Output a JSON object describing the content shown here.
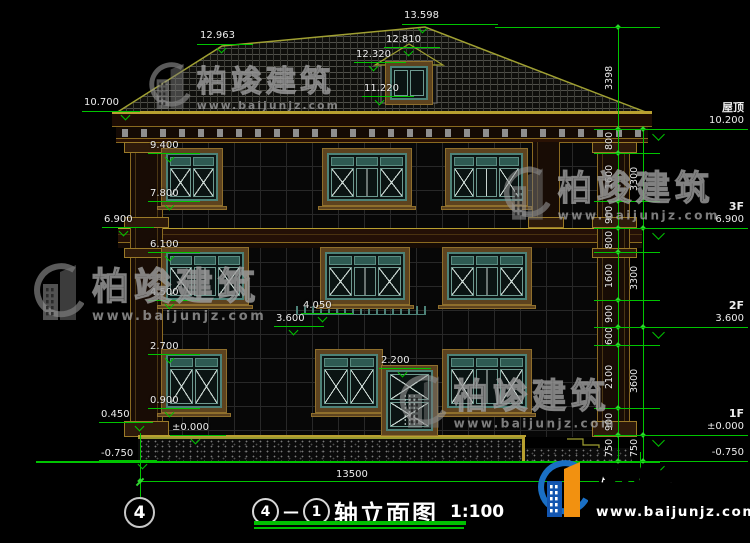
{
  "watermark": {
    "brand": "柏竣建筑",
    "url": "www.baijunjz.com"
  },
  "title_block": {
    "axis_start": "4",
    "separator": "—",
    "axis_end": "1",
    "title": "轴立面图",
    "scale": "1:100"
  },
  "axis_bubble": "4",
  "colors": {
    "dim_green": "#00c400",
    "trim_yellow": "#a0a032",
    "frame_teal": "#4d8278",
    "logo_blue": "#1a6fc4",
    "logo_orange": "#f29110",
    "text_white": "#e8e8e8"
  },
  "drawing": {
    "levels_left": [
      {
        "label": "13.598",
        "tx": 404,
        "ty": 10,
        "lx": 402,
        "ly": 24,
        "lw": 96,
        "vx": 423
      },
      {
        "label": "12.963",
        "tx": 200,
        "ty": 30,
        "lx": 197,
        "ly": 44,
        "lw": 56,
        "vx": 222
      },
      {
        "label": "12.810",
        "tx": 386,
        "ty": 34,
        "lx": 384,
        "ly": 47,
        "lw": 56,
        "vx": 409
      },
      {
        "label": "12.320",
        "tx": 356,
        "ty": 49,
        "lx": 354,
        "ly": 62,
        "lw": 52,
        "vx": 374
      },
      {
        "label": "11.220",
        "tx": 364,
        "ty": 83,
        "lx": 362,
        "ly": 96,
        "lw": 52,
        "vx": 380
      },
      {
        "label": "10.700",
        "tx": 84,
        "ty": 97,
        "lx": 82,
        "ly": 111,
        "lw": 58,
        "vx": 126
      },
      {
        "label": "9.400",
        "tx": 150,
        "ty": 140,
        "lx": 148,
        "ly": 153,
        "lw": 52,
        "vx": 170
      },
      {
        "label": "7.800",
        "tx": 150,
        "ty": 188,
        "lx": 148,
        "ly": 201,
        "lw": 52,
        "vx": 170
      },
      {
        "label": "6.900",
        "tx": 104,
        "ty": 214,
        "lx": 102,
        "ly": 227,
        "lw": 52,
        "vx": 124
      },
      {
        "label": "6.100",
        "tx": 150,
        "ty": 239,
        "lx": 148,
        "ly": 252,
        "lw": 52,
        "vx": 170
      },
      {
        "label": "4.500",
        "tx": 150,
        "ty": 287,
        "lx": 148,
        "ly": 300,
        "lw": 52,
        "vx": 170
      },
      {
        "label": "4.050",
        "tx": 303,
        "ty": 300,
        "lx": 301,
        "ly": 313,
        "lw": 52,
        "vx": 323
      },
      {
        "label": "3.600",
        "tx": 276,
        "ty": 313,
        "lx": 274,
        "ly": 326,
        "lw": 50,
        "vx": 294
      },
      {
        "label": "2.700",
        "tx": 150,
        "ty": 341,
        "lx": 148,
        "ly": 354,
        "lw": 52,
        "vx": 170
      },
      {
        "label": "2.200",
        "tx": 381,
        "ty": 355,
        "lx": 379,
        "ly": 368,
        "lw": 52,
        "vx": 403
      },
      {
        "label": "0.900",
        "tx": 150,
        "ty": 395,
        "lx": 148,
        "ly": 408,
        "lw": 52,
        "vx": 170
      },
      {
        "label": "0.450",
        "tx": 101,
        "ty": 409,
        "lx": 99,
        "ly": 422,
        "lw": 54,
        "vx": 140
      },
      {
        "label": "±0.000",
        "tx": 172,
        "ty": 422,
        "lx": 170,
        "ly": 435,
        "lw": 56,
        "vx": 196
      },
      {
        "label": "-0.750",
        "tx": 101,
        "ty": 448,
        "lx": 99,
        "ly": 460,
        "lw": 58,
        "vx": 143
      }
    ],
    "levels_right": [
      {
        "name": "屋顶",
        "value": "10.200",
        "y": 129
      },
      {
        "name": "3F",
        "value": "6.900",
        "y": 228
      },
      {
        "name": "2F",
        "value": "3.600",
        "y": 327
      },
      {
        "name": "1F",
        "value": "±0.000",
        "y": 435
      },
      {
        "name": "",
        "value": "-0.750",
        "y": 461
      }
    ],
    "dim_columns": [
      {
        "x": 618,
        "boundaries": [
          27,
          129,
          153,
          201,
          228,
          252,
          300,
          327,
          345,
          408,
          435,
          461
        ],
        "labels": [
          "3398",
          "800",
          "1600",
          "900",
          "800",
          "1600",
          "900",
          "600",
          "2100",
          "900",
          "750"
        ]
      },
      {
        "x": 643,
        "boundaries": [
          129,
          228,
          327,
          435,
          461
        ],
        "labels": [
          "3300",
          "3300",
          "3600",
          "750"
        ]
      }
    ],
    "bottom_dim": {
      "label": "13500",
      "x1": 140,
      "x2": 640,
      "y": 481,
      "tx": 336,
      "ty": 469
    },
    "green_lines": [
      {
        "x": 495,
        "y": 27,
        "w": 126,
        "h": 1
      },
      {
        "x": 140,
        "y": 433,
        "w": 1,
        "h": 64
      },
      {
        "x": 640,
        "y": 452,
        "w": 1,
        "h": 36
      },
      {
        "x": 36,
        "y": 461,
        "w": 624,
        "h": 2
      }
    ],
    "windows": [
      {
        "x": 166,
        "y": 153,
        "w": 52,
        "h": 48,
        "cols": 2
      },
      {
        "x": 327,
        "y": 153,
        "w": 80,
        "h": 48,
        "cols": 3
      },
      {
        "x": 450,
        "y": 153,
        "w": 73,
        "h": 48,
        "cols": 3
      },
      {
        "x": 166,
        "y": 252,
        "w": 78,
        "h": 48,
        "cols": 3
      },
      {
        "x": 325,
        "y": 252,
        "w": 80,
        "h": 48,
        "cols": 3
      },
      {
        "x": 447,
        "y": 252,
        "w": 80,
        "h": 48,
        "cols": 3
      },
      {
        "x": 166,
        "y": 354,
        "w": 56,
        "h": 54,
        "cols": 2
      },
      {
        "x": 320,
        "y": 354,
        "w": 58,
        "h": 54,
        "cols": 2
      },
      {
        "x": 447,
        "y": 354,
        "w": 80,
        "h": 54,
        "cols": 3
      },
      {
        "x": 390,
        "y": 66,
        "w": 38,
        "h": 34,
        "cols": 2,
        "plain": true,
        "transom": false,
        "sill": false
      }
    ],
    "door": {
      "x": 386,
      "y": 369,
      "w": 47,
      "h": 67
    },
    "watermarks_gray": [
      {
        "x": 146,
        "y": 58,
        "s": 0.82
      },
      {
        "x": 30,
        "y": 258,
        "s": 1.0
      },
      {
        "x": 500,
        "y": 162,
        "s": 0.93
      },
      {
        "x": 396,
        "y": 370,
        "s": 0.93
      }
    ],
    "brand_mark": {
      "x": 534,
      "y": 455
    }
  }
}
